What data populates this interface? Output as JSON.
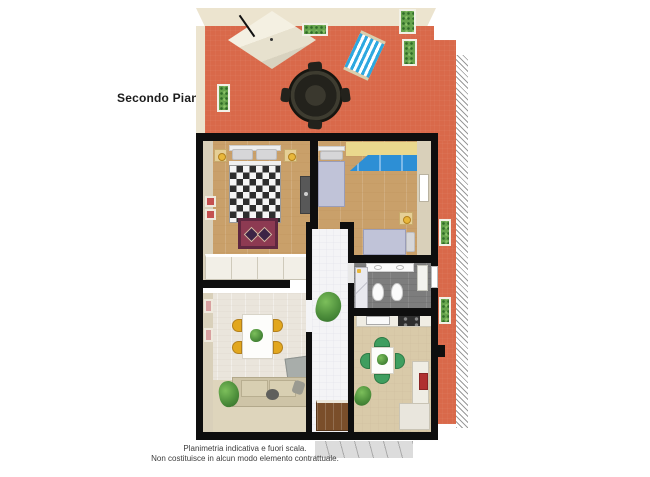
{
  "title": {
    "label": "Secondo Piano"
  },
  "disclaimer": {
    "line1": "Planimetria indicativa e fuori scala.",
    "line2": "Non costituisce in alcun modo elemento contrattuale."
  },
  "colors": {
    "wall": "#0e0e0e",
    "terrace_tile": "#d9694a",
    "terrace_tile_line": "#e4907423",
    "terrace_border": "#ece4cf",
    "deckchair_blue": "#2ea8e0",
    "plant_dark": "#2f6b28",
    "wood_floor": "#c9a06a",
    "wood_line": "#b98f5833",
    "bed_blanket_grey": "#c0c3d8",
    "checker_dark": "#2e2e2e",
    "checker_light": "#f5f5f5",
    "rug_red": "#8d3a52",
    "rug_border": "#5f2740",
    "lamp_yellow": "#e8b73a",
    "wardrobe_dark": "#585858",
    "closet_white": "#f2efe7",
    "yellow_wall": "#ead88d",
    "blue_cabinet": "#2d8fd5",
    "beige_wall": "#d9d0ba",
    "bath_floor": "#7d7d7d",
    "bath_floor_dark": "#66666655",
    "fixture_white": "#fbfbfb",
    "vanity_red": "#9c2121",
    "corridor_tile": "#f4f4f6",
    "corridor_line": "#dfdfe644",
    "door_brown": "#7a4e2a",
    "living_floor": "#eae5dc",
    "living_brick": "#d6cfc233",
    "living_lower": "#ded5bc",
    "dining_chair_yellow": "#e2a71e",
    "sofa_beige": "#cec4a7",
    "coffee_table_grey": "#a8adaa",
    "art_red": "#c45050",
    "kitchen_floor": "#d9caa9",
    "kitchen_tile_line": "#ccbd9c44",
    "stove_dark": "#2e2e2e",
    "kitchen_chair_green": "#3f9e5f",
    "fridge_red": "#b03030",
    "hatch_line": "#9a9a9a",
    "watermark_grey": "#dcdcdc",
    "text_dark": "#1c1c1c",
    "text_grey": "#3c3c3c"
  }
}
